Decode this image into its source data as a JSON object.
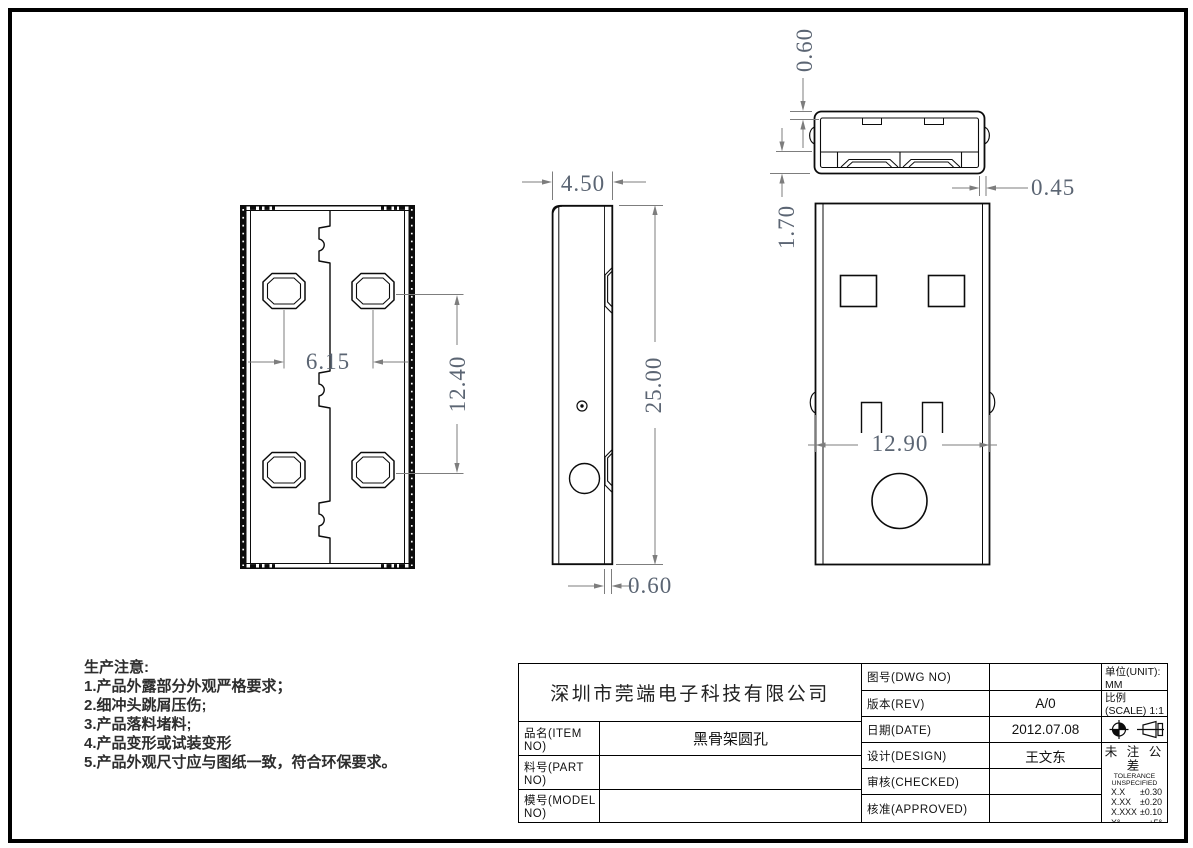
{
  "colors": {
    "line": "#0c0c0c",
    "dimension_line": "#7d7d7d",
    "dimension_text": "#5b6573",
    "background": "#ffffff"
  },
  "icons": {
    "title_block_symbols": [
      "datum-target-icon",
      "third-angle-projection-icon"
    ]
  },
  "dimensions": {
    "top_view_wall": "0.60",
    "top_view_lip": "1.70",
    "top_view_side_wall": "0.45",
    "side_view_depth": "4.50",
    "body_length": "25.00",
    "side_view_bottom_wall": "0.60",
    "hole_pitch_x": "6.15",
    "hole_pitch_y": "12.40",
    "body_width": "12.90"
  },
  "notes": {
    "title": "生产注意:",
    "items": [
      "1.产品外露部分外观严格要求；",
      "2.细冲头跳屑压伤;",
      "3.产品落料堵料;",
      "4.产品变形或试装变形",
      "5.产品外观尺寸应与图纸一致，符合环保要求。"
    ]
  },
  "tb": {
    "company": "深圳市莞端电子科技有限公司",
    "item_label": "品名(ITEM NO)",
    "item_value": "黑骨架圆孔",
    "part_label": "料号(PART NO)",
    "part_value": "",
    "model_label": "模号(MODEL NO)",
    "model_value": "",
    "dwg_label": "图号(DWG NO)",
    "dwg_value": "",
    "rev_label": "版本(REV)",
    "rev_value": "A/0",
    "date_label": "日期(DATE)",
    "date_value": "2012.07.08",
    "design_label": "设计(DESIGN)",
    "design_value": "王文东",
    "checked_label": "审核(CHECKED)",
    "checked_value": "",
    "approved_label": "核准(APPROVED)",
    "approved_value": "",
    "unit_label": "单位(UNIT): MM",
    "scale_label": "比例(SCALE) 1:1",
    "tol_title": "未 注 公 差",
    "tol_subtitle": "TOLERANCE UNSPECIFIED",
    "tol_rows": [
      [
        "X.X",
        "±0.30"
      ],
      [
        "X.XX",
        "±0.20"
      ],
      [
        "X.XXX",
        "±0.10"
      ],
      [
        "X°",
        "±5°"
      ],
      [
        "X.X°",
        "±2°"
      ]
    ]
  }
}
